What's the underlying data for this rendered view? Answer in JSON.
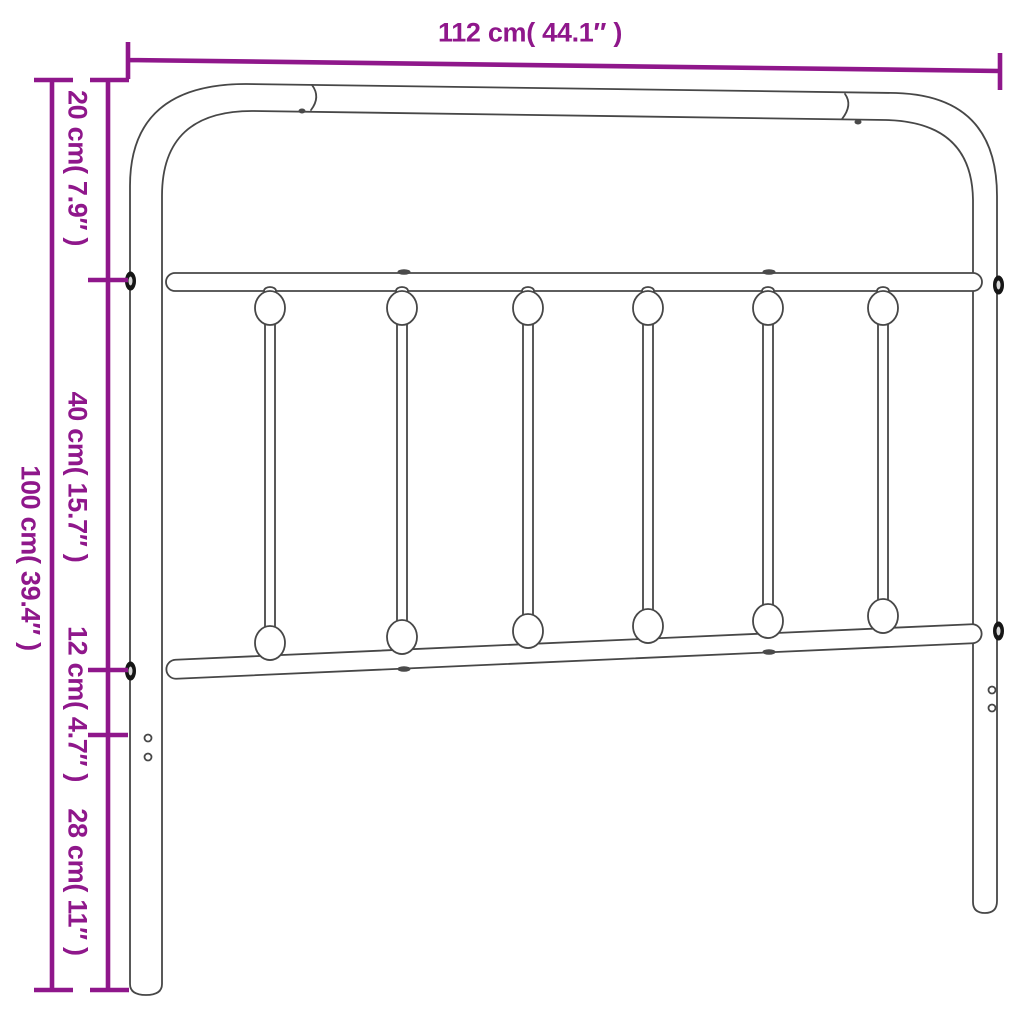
{
  "figure": {
    "type": "product dimension diagram",
    "subject": "metal headboard",
    "spindle_count": 6
  },
  "colors": {
    "dimension": "#8F178B",
    "outline": "#474747",
    "background": "#ffffff"
  },
  "dimensions": {
    "width": "112 cm( 44.1″ )",
    "height_total": "100 cm( 39.4″ )",
    "top_section": "20 cm( 7.9″ )",
    "middle_section": "40 cm( 15.7″ )",
    "rail_section": "12 cm( 4.7″ )",
    "bottom_section": "28 cm( 11″ )"
  }
}
